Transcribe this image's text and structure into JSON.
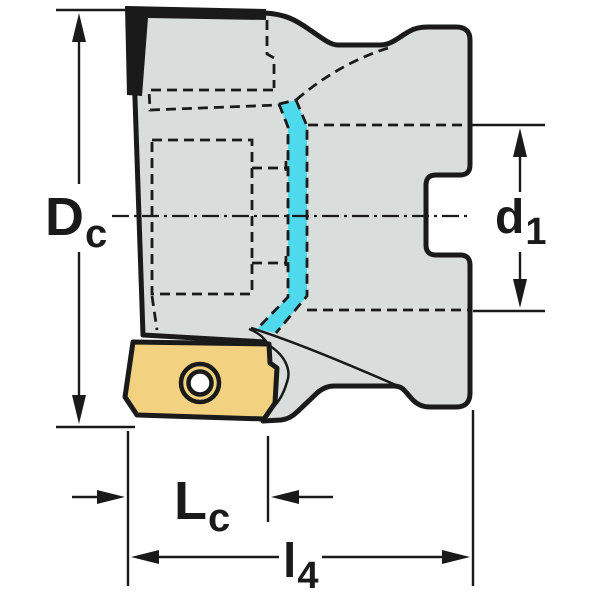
{
  "labels": {
    "dc": {
      "main": "D",
      "sub": "c"
    },
    "d1": {
      "main": "d",
      "sub": "1"
    },
    "lc": {
      "main": "L",
      "sub": "c"
    },
    "l4": {
      "main": "l",
      "sub": "4"
    }
  },
  "colors": {
    "background": "#ffffff",
    "line": "#1a1a1a",
    "body_fill": "#d9dddc",
    "insert_fill": "#f2d180",
    "flute_highlight": "#4fd9ec",
    "hole_fill": "#ffffff"
  }
}
